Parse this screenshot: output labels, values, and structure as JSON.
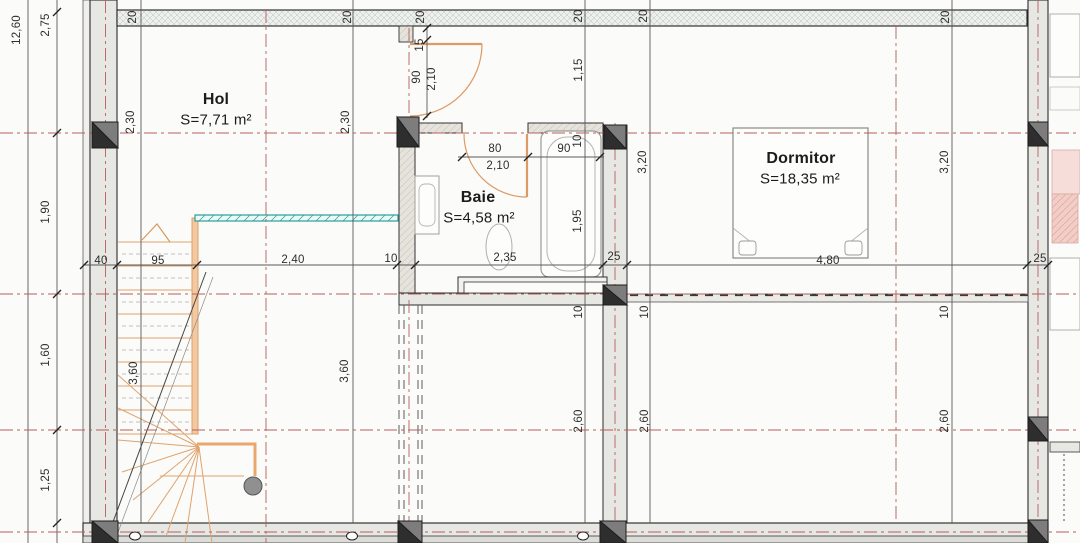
{
  "rooms": {
    "hol": {
      "name": "Hol",
      "area": "S=7,71 m²"
    },
    "baie": {
      "name": "Baie",
      "area": "S=4,58 m²"
    },
    "dormitor": {
      "name": "Dormitor",
      "area": "S=18,35 m²"
    }
  },
  "dims": {
    "total_height": "12,60",
    "left_chain": {
      "s1": "2,75",
      "s2": "1,90",
      "s3": "1,60",
      "s4": "1,25"
    },
    "beam_thickness": {
      "b1": "20",
      "b2": "20",
      "b3": "20",
      "b4": "20",
      "b5": "20",
      "b6": "20"
    },
    "bottom_chain": {
      "c1": "40",
      "c2": "95",
      "c3": "2,40",
      "c4": "10",
      "c5": "2,35",
      "c6": "25",
      "c7": "4,80",
      "c8": "25"
    },
    "grid_segments": {
      "g230a": "2,30",
      "g230b": "2,30",
      "g115": "1,15",
      "g320a": "3,20",
      "g320b": "3,20",
      "g195": "1,95",
      "g10a": "10",
      "g10b": "10",
      "g10c": "10",
      "g260a": "2,60",
      "g260b": "2,60",
      "g260c": "2,60",
      "g360a": "3,60",
      "g360b": "3,60"
    },
    "hol_door": {
      "offset": "15",
      "width": "90",
      "height": "2,10"
    },
    "baie_door": {
      "width": "80",
      "height": "2,10",
      "tub_width": "90",
      "wall": "10"
    }
  },
  "colors": {
    "wall_fill": "#e7e7e4",
    "column_fill": "#7d7d7d",
    "centerline_red": "#b45f5a",
    "stair_orange": "#dfa36e",
    "railing_teal": "#2e9e98",
    "annex_pink": "#f3cdc7",
    "text": "#2e2e2e"
  }
}
